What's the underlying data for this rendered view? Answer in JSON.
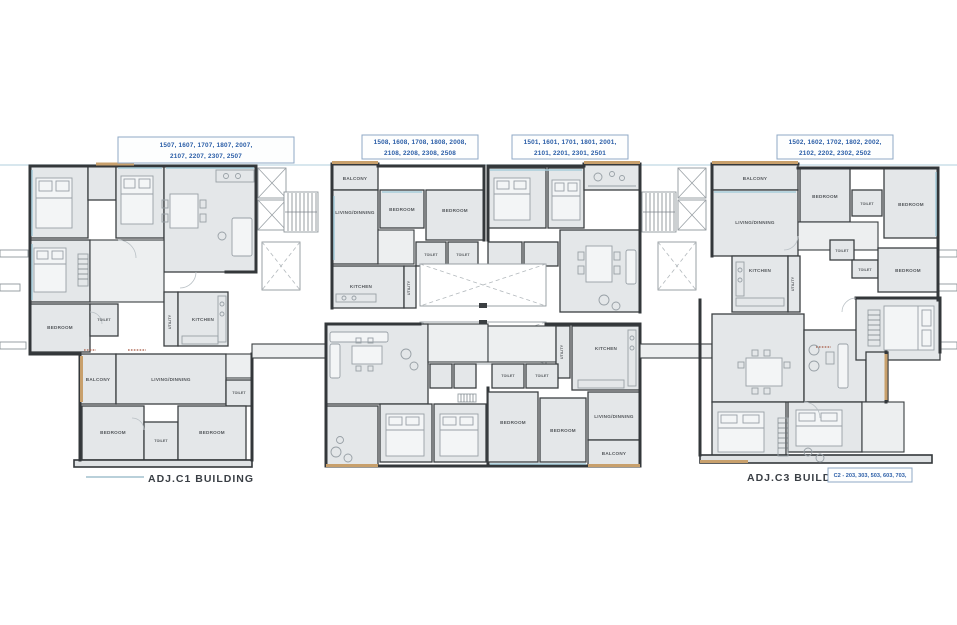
{
  "colors": {
    "wall": "#3b3f42",
    "room_fill": "#e4e7e9",
    "corridor_fill": "#edeff0",
    "balcony_accent_tan": "#c8a06c",
    "window_accent_blue": "#a8cddb",
    "label_blue": "#2b5ea7",
    "room_text_gray": "#54585c",
    "red_accent": "#a4553f"
  },
  "room_labels": {
    "bedroom": "BEDROOM",
    "kitchen": "KITCHEN",
    "living_dining": "LIVING/DINNING",
    "toilet": "TOILET",
    "balcony": "BALCONY",
    "utility": "UTILITY"
  },
  "unit_number_boxes": [
    {
      "line1": "1507, 1607, 1707, 1807, 2007,",
      "line2": "2107, 2207, 2307, 2507"
    },
    {
      "line1": "1508, 1608, 1708, 1808, 2008,",
      "line2": "2108, 2208, 2308, 2508"
    },
    {
      "line1": "1501, 1601, 1701, 1801, 2001,",
      "line2": "2101, 2201, 2301, 2501"
    },
    {
      "line1": "1502, 1602, 1702, 1802, 2002,",
      "line2": "2102, 2202, 2302, 2502"
    }
  ],
  "units": {
    "left_building_rooms": [
      "BEDROOM",
      "TOILET",
      "UTILITY",
      "KITCHEN",
      "BALCONY",
      "LIVING/DINNING",
      "TOILET",
      "BEDROOM",
      "TOILET",
      "BEDROOM"
    ],
    "center_top_left_rooms": [
      "BALCONY",
      "LIVING/DINNING",
      "BEDROOM",
      "BEDROOM",
      "TOILET",
      "TOILET",
      "KITCHEN",
      "UTILITY"
    ],
    "center_bottom_right_rooms": [
      "KITCHEN",
      "UTILITY",
      "TOILET",
      "TOILET",
      "BEDROOM",
      "BEDROOM",
      "LIVING/DINNING",
      "BALCONY"
    ],
    "right_building_rooms": [
      "BALCONY",
      "LIVING/DINNING",
      "BEDROOM",
      "TOILET",
      "BEDROOM",
      "TOILET",
      "TOILET",
      "BEDROOM",
      "KITCHEN",
      "UTILITY"
    ]
  },
  "footer": {
    "left_building_label": "ADJ.C1 BUILDING",
    "right_building_label": "ADJ.C3 BUILDING",
    "right_units_note": "C2 - 203, 303, 503, 603, 703,"
  }
}
